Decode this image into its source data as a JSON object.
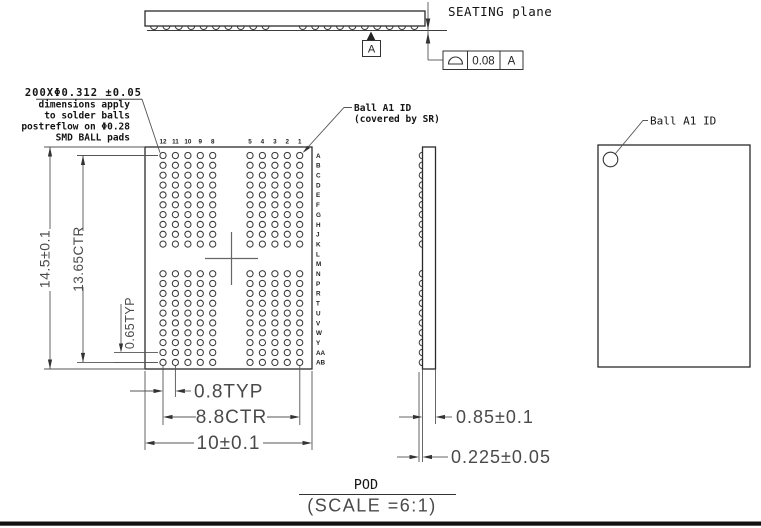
{
  "drawing": {
    "title": "POD",
    "scale_note": "(SCALE =6:1)",
    "seating_plane_label": "SEATING plane",
    "datum_label": "A",
    "tolerance_frame": {
      "symbol_icon": "profile-semicircle-icon",
      "value": "0.08",
      "datum": "A"
    },
    "ball_note": {
      "line1": "200XΦ0.312 ±0.05",
      "line2": "dimensions apply",
      "line3": "to solder balls",
      "line4": "postreflow on Φ0.28",
      "line5": "SMD BALL pads"
    },
    "ball_a1_note": {
      "line1": "Ball A1 ID",
      "line2": "(covered by SR)"
    },
    "ball_a1_top_label": "Ball A1 ID",
    "dimensions": {
      "height": "14.5±0.1",
      "height_ctr": "13.65CTR",
      "row_pitch": "0.65TYP",
      "col_pitch": "0.8TYP",
      "width_ctr": "8.8CTR",
      "width": "10±0.1",
      "thickness": "0.85±0.1",
      "ball_height": "0.225±0.05"
    },
    "grid": {
      "column_labels": [
        "12",
        "11",
        "10",
        "9",
        "8",
        "5",
        "4",
        "3",
        "2",
        "1"
      ],
      "row_labels": [
        "A",
        "B",
        "C",
        "D",
        "E",
        "F",
        "G",
        "H",
        "J",
        "K",
        "L",
        "M",
        "N",
        "P",
        "R",
        "T",
        "U",
        "V",
        "W",
        "Y",
        "AA",
        "AB"
      ],
      "rows_without_balls": [
        "L",
        "M"
      ],
      "ball_count": 200
    }
  }
}
